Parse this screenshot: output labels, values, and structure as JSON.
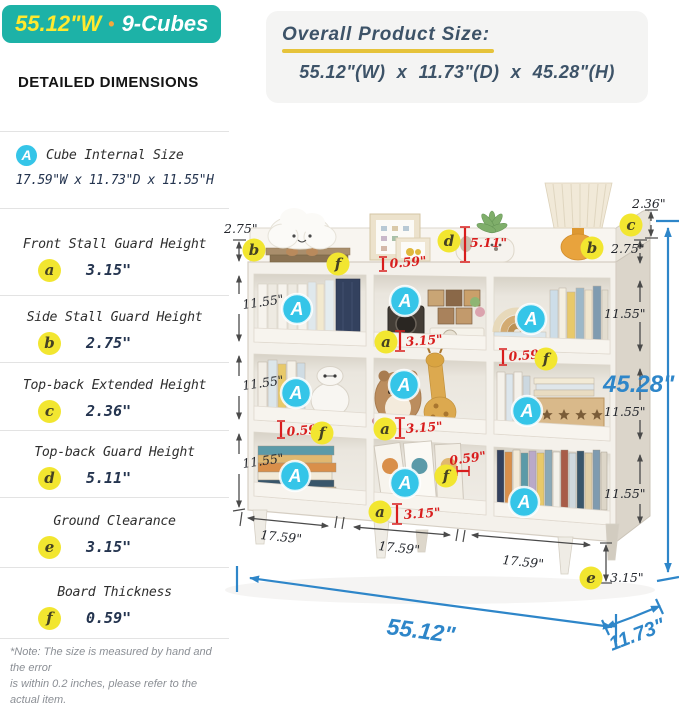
{
  "badge": {
    "width": "55.12\"W",
    "dot": "•",
    "cubes": "9-Cubes"
  },
  "sidebar": {
    "title": "DETAILED DIMENSIONS",
    "items": [
      {
        "key": "A",
        "label": "Cube Internal Size",
        "value": "17.59\"W x 11.73\"D x 11.55\"H"
      },
      {
        "key": "a",
        "label": "Front Stall Guard Height",
        "value": "3.15\""
      },
      {
        "key": "b",
        "label": "Side Stall Guard Height",
        "value": "2.75\""
      },
      {
        "key": "c",
        "label": "Top-back Extended Height",
        "value": "2.36\""
      },
      {
        "key": "d",
        "label": "Top-back Guard Height",
        "value": "5.11\""
      },
      {
        "key": "e",
        "label": "Ground Clearance",
        "value": "3.15\""
      },
      {
        "key": "f",
        "label": "Board Thickness",
        "value": "0.59\""
      }
    ],
    "note_line1": "*Note: The size is measured by hand and the error",
    "note_line2": "is within 0.2 inches, please refer to the actual item."
  },
  "overall": {
    "title": "Overall Product Size:",
    "dimensions": "55.12\"(W) x 11.73\"(D) x 45.28\"(H)"
  },
  "diagram": {
    "cube_marker": "A",
    "letters": {
      "a": "a",
      "b": "b",
      "c": "c",
      "d": "d",
      "e": "e",
      "f": "f"
    },
    "labels": {
      "total_height": "45.28\"",
      "total_width": "55.12\"",
      "total_depth": "11.73\"",
      "cube_height": "11.55\"",
      "cube_width": "17.59\"",
      "side_guard": "2.75\"",
      "top_back_extended": "2.36\"",
      "top_back_guard": "5.11\"",
      "front_guard": "3.15\"",
      "ground_clearance": "3.15\"",
      "board_thickness": "0.59\""
    }
  },
  "colors": {
    "teal": "#1db2a7",
    "badge_yellow": "#ffe92e",
    "badge_dot_orange": "#f6a83b",
    "marker_yellow": "#f2e630",
    "marker_cyan": "#35c5e8",
    "dim_red": "#d81d1d",
    "dim_blue": "#2e86c9",
    "overall_text": "#3d5368",
    "underline_yellow": "#e6c33a"
  }
}
